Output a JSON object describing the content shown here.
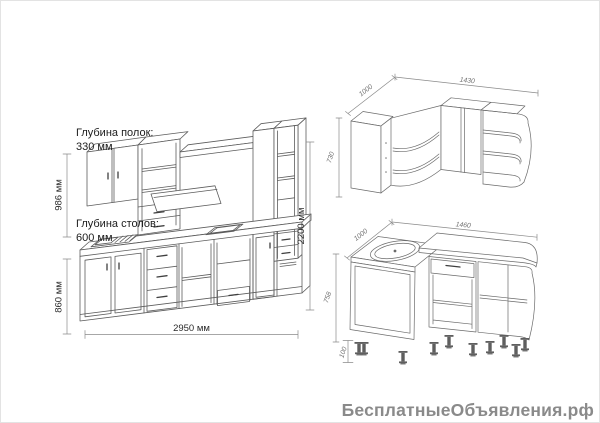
{
  "watermark": {
    "text": "БесплатныеОбъявления.рф"
  },
  "straight_kitchen": {
    "shelf_depth_label": "Глубина полок:",
    "shelf_depth_value": "330 мм",
    "counter_depth_label": "Глубина столов:",
    "counter_depth_value": "600 мм",
    "upper_height": "986 мм",
    "base_height": "860 мм",
    "total_height": "2200 мм",
    "total_length": "2950 мм"
  },
  "corner_wall_unit": {
    "side_depth": "1000",
    "length": "1430",
    "height": "730"
  },
  "corner_base_unit": {
    "side_depth": "1000",
    "length": "1460",
    "height": "758",
    "leg_height": "100"
  }
}
